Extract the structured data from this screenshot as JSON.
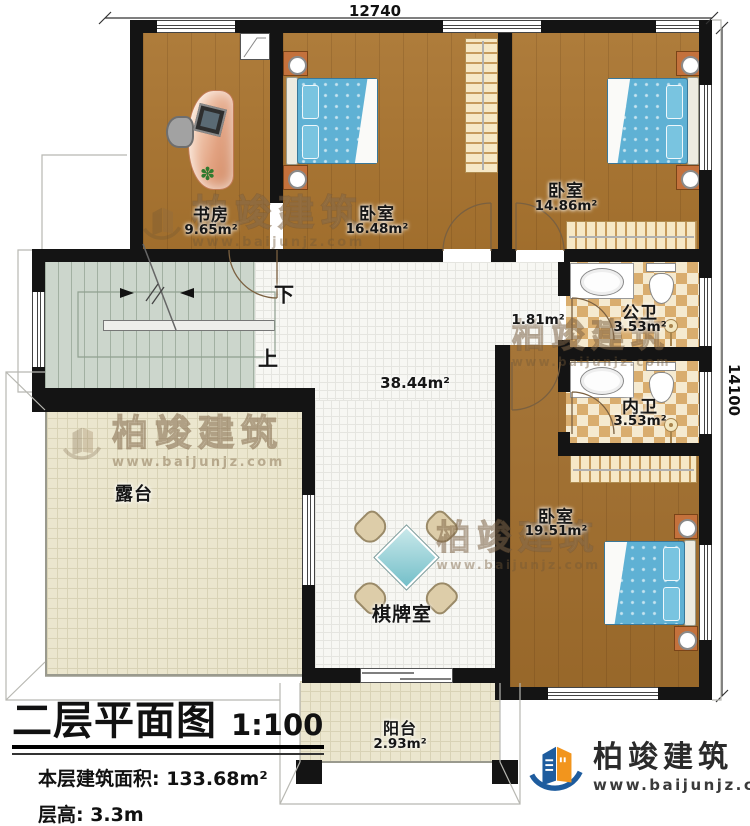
{
  "dimensions": {
    "top": "12740",
    "right": "14100"
  },
  "rooms": {
    "study": {
      "name": "书房",
      "area": "9.65m²"
    },
    "bedroom_top": {
      "name": "卧室",
      "area": "16.48m²"
    },
    "bedroom_right": {
      "name": "卧室",
      "area": "14.86m²"
    },
    "public_bath": {
      "name": "公卫",
      "area": "3.53m²"
    },
    "inner_bath": {
      "name": "内卫",
      "area": "3.53m²"
    },
    "bedroom_bottom": {
      "name": "卧室",
      "area": "19.51m²"
    },
    "hall": {
      "area": "38.44m²"
    },
    "corridor": {
      "area": "1.81m²"
    },
    "chess_room": {
      "name": "棋牌室"
    },
    "terrace": {
      "name": "露台"
    },
    "balcony": {
      "name": "阳台",
      "area": "2.93m²"
    },
    "stairs": {
      "down": "下",
      "up": "上"
    }
  },
  "title_block": {
    "title": "二层平面图",
    "scale": "1:100",
    "floor_area": "本层建筑面积: 133.68m²",
    "floor_height": "层高: 3.3m"
  },
  "brand": {
    "name": "柏竣建筑",
    "url": "www.baijunjz.com"
  },
  "colors": {
    "wall": "#141414",
    "wood_floor": "#a9742f",
    "tile_floor": "#f7f7f3",
    "bath_checker": "#d9ad6e",
    "bed_blue": "#5fb1d4",
    "stair_green": "#ccd6cc",
    "terrace_cream": "#ebe6ce",
    "logo_blue": "#1e5c9e",
    "logo_orange": "#f2951d"
  }
}
